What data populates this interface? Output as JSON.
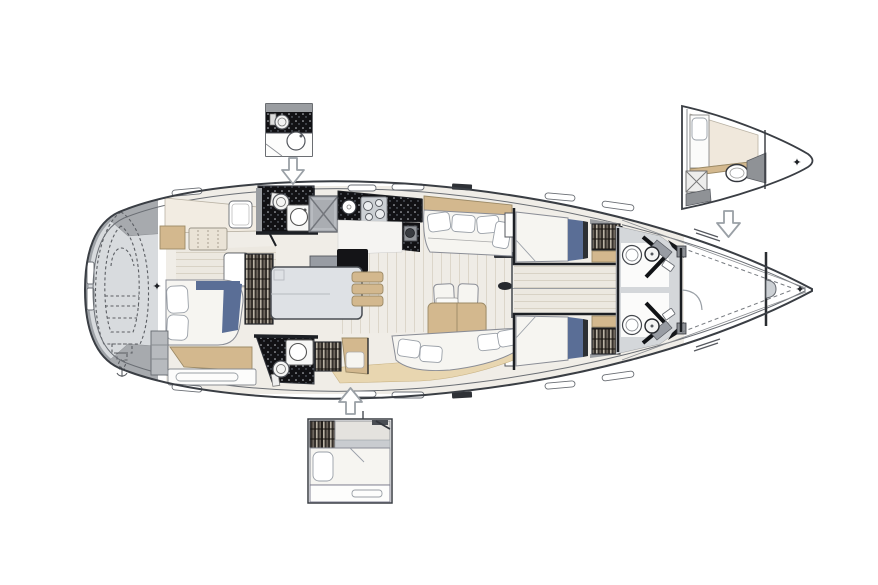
{
  "diagram": {
    "type": "sailing-yacht-interior-deck-plan",
    "marker_glyphs": {
      "stern": "✦",
      "bow": "✦",
      "inset_bow": "✦"
    }
  },
  "colors": {
    "background": "#ffffff",
    "hullStroke": "#3a3e44",
    "deckGray": "#d8dbde",
    "deckGrayDark": "#a7aaae",
    "floorWood": "#f0ede7",
    "plankLine": "#dcd6ca",
    "tan": "#d3b88e",
    "tanDark": "#9c8a66",
    "counterBlack": "#141417",
    "grayMid": "#989ca3",
    "blue": "#5a6e96",
    "cushion": "#f6f5f1",
    "wall": "#1c1f24",
    "arrowStroke": "#9aa0a6"
  }
}
